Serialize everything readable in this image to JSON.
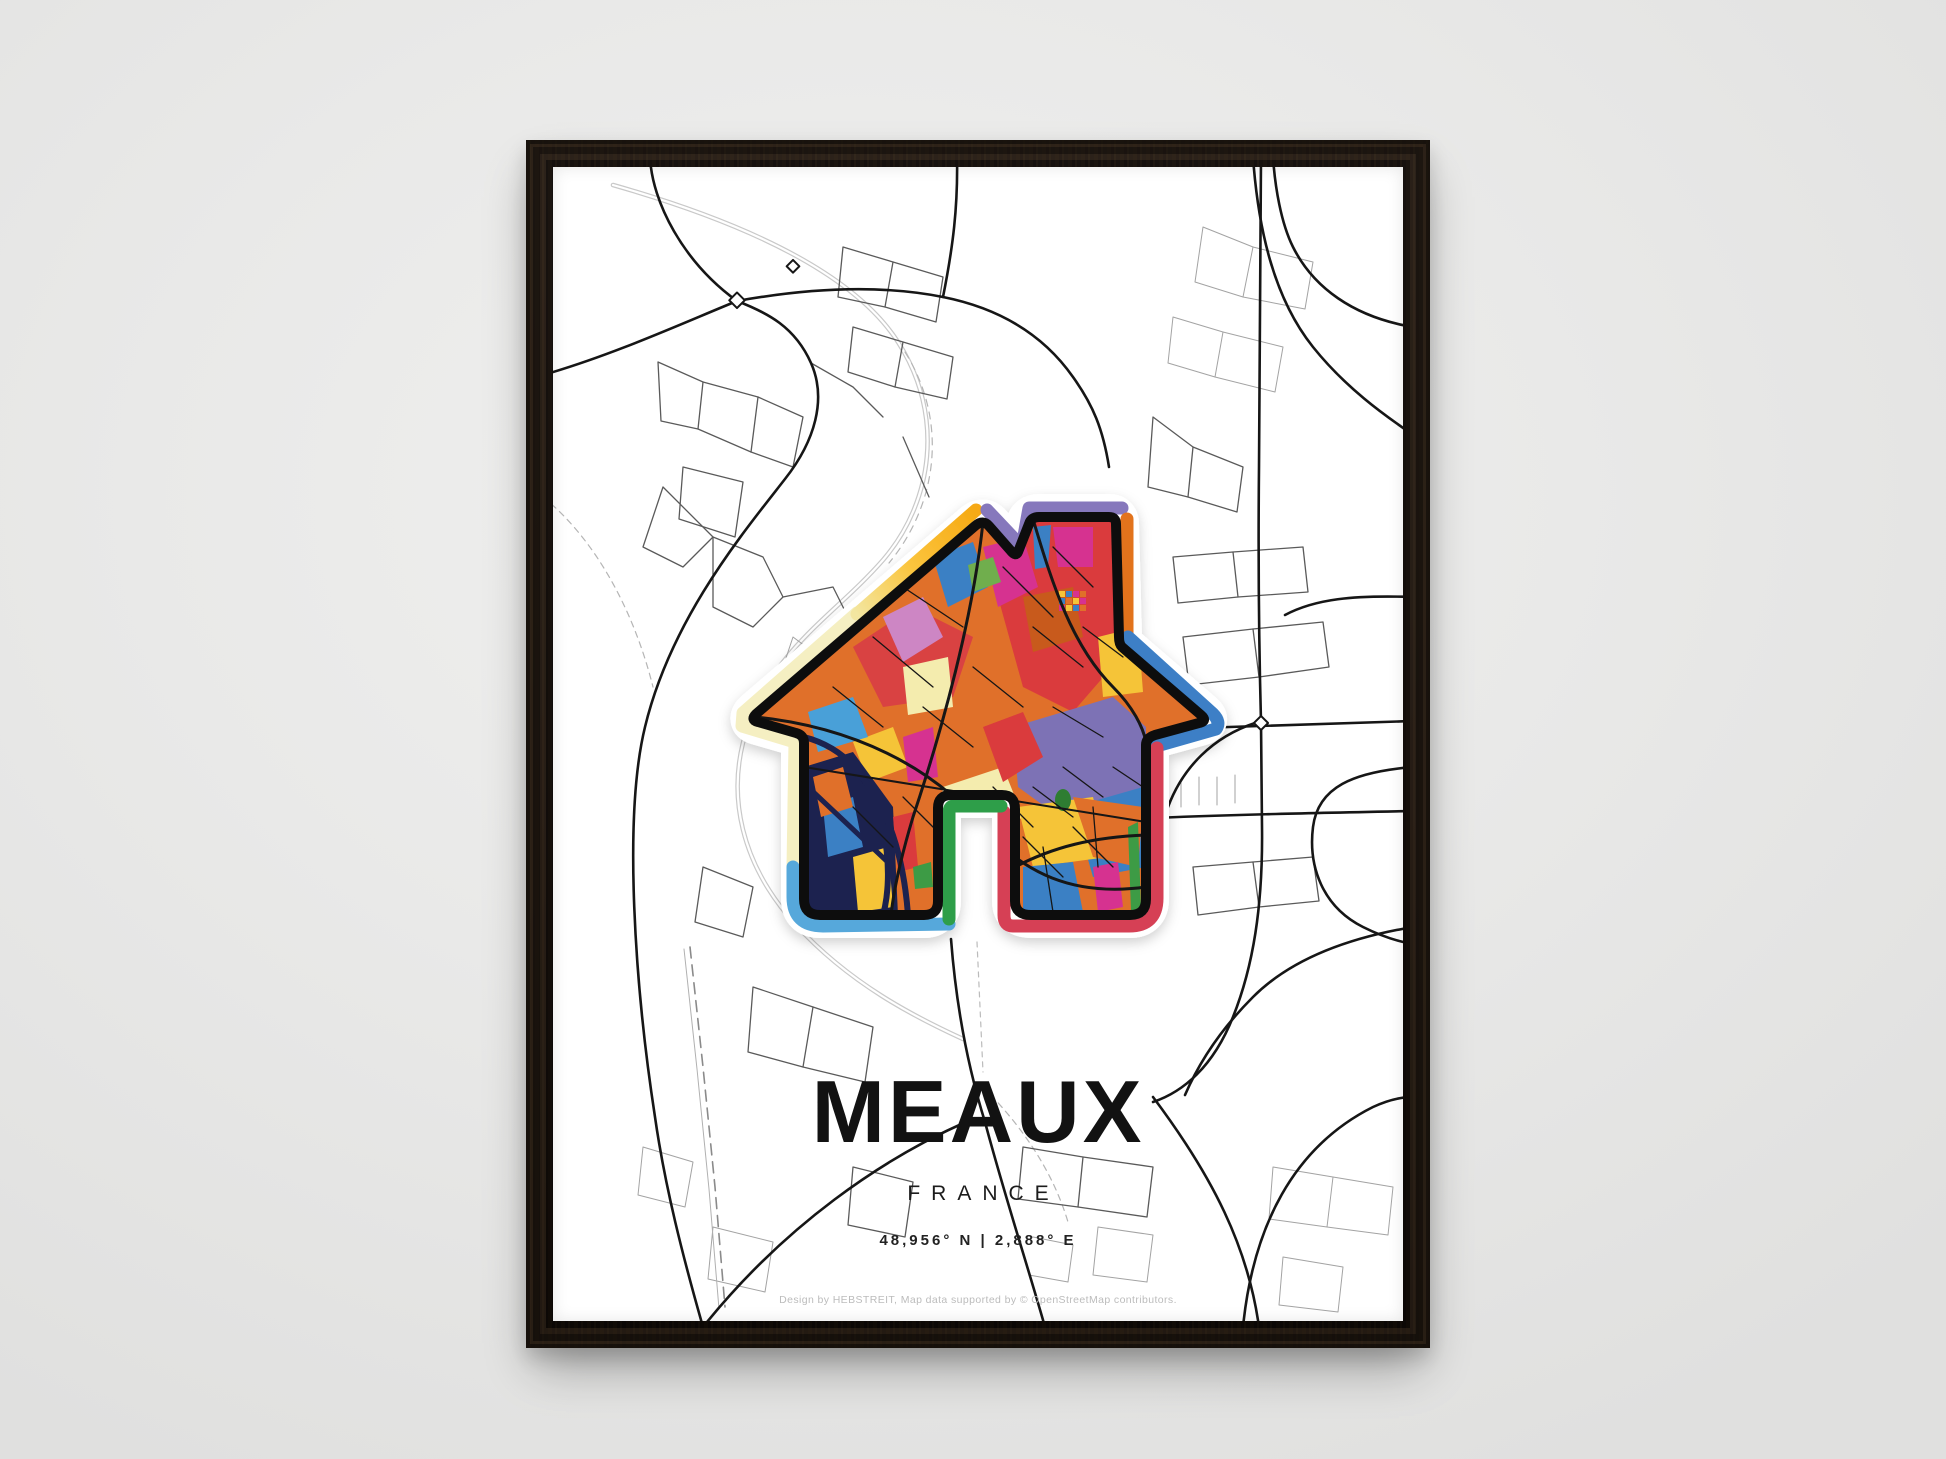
{
  "poster": {
    "title": "MEAUX",
    "subtitle": "FRANCE",
    "coordinates": "48,956° N | 2,888° E",
    "credit": "Design by HEBSTREIT, Map data supported by © OpenStreetMap contributors."
  },
  "colors": {
    "wall": "#e9e9e8",
    "frame_wood": "#221711",
    "paper": "#ffffff",
    "title_text": "#121212",
    "credit_text": "#bcbcbc",
    "map_road_main": "#161616",
    "map_road_mid": "#5a5a5a",
    "map_road_light": "#a3a3a3",
    "map_river": "#c9c9c9",
    "house_outline": "#0d0d0d",
    "band_cream": "#f5efc2",
    "band_gold": "#f6a913",
    "band_purple": "#8678bc",
    "band_orange": "#e2731d",
    "band_blue": "#3c7fc6",
    "band_red": "#d63f55",
    "band_lightblue": "#56a8db",
    "band_green": "#2f9e49",
    "art_orange": "#e0702b",
    "art_red": "#da3a3c",
    "art_magenta": "#d63390",
    "art_plum": "#cd86c4",
    "art_blue": "#3a80c4",
    "art_yellow": "#f5c437",
    "art_cream": "#f4ecae",
    "art_purple": "#7d72b5",
    "art_green": "#3d9b44",
    "art_navy": "#1b2150"
  }
}
